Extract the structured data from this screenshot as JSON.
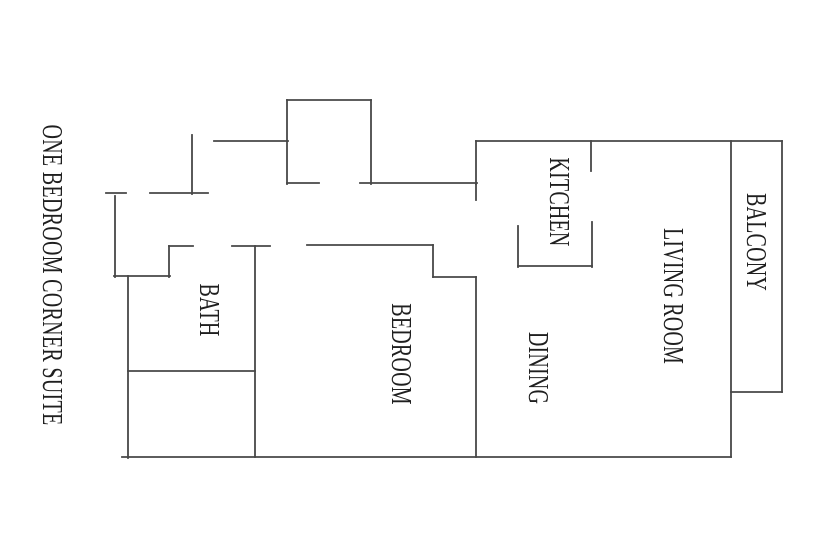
{
  "document": {
    "background_color": "#ffffff",
    "wall_color": "#474747",
    "text_color": "#1f1f1f",
    "wall_thickness": 1.8
  },
  "floorplan": {
    "title": {
      "text": "ONE BEDROOM CORNER SUITE",
      "x": 51,
      "y": 275
    },
    "rooms": [
      {
        "id": "bath",
        "text": "BATH",
        "x": 208,
        "y": 310
      },
      {
        "id": "bedroom",
        "text": "BEDROOM",
        "x": 400,
        "y": 354
      },
      {
        "id": "dining",
        "text": "DINING",
        "x": 537,
        "y": 368
      },
      {
        "id": "kitchen",
        "text": "KITCHEN",
        "x": 558,
        "y": 202
      },
      {
        "id": "living-room",
        "text": "LIVING ROOM",
        "x": 672,
        "y": 296
      },
      {
        "id": "balcony",
        "text": "BALCONY",
        "x": 755,
        "y": 242
      }
    ],
    "walls": [
      {
        "name": "entry-door-left-jamb",
        "x1": 106,
        "y1": 193,
        "x2": 126,
        "y2": 193
      },
      {
        "name": "left-outer-wall-upper",
        "x1": 115,
        "y1": 196,
        "x2": 115,
        "y2": 277
      },
      {
        "name": "entry-step-bottom-wall",
        "x1": 114,
        "y1": 276,
        "x2": 170,
        "y2": 276
      },
      {
        "name": "entry-step-right-wall",
        "x1": 169,
        "y1": 246,
        "x2": 169,
        "y2": 277
      },
      {
        "name": "bath-top-wall-left",
        "x1": 169,
        "y1": 246,
        "x2": 193,
        "y2": 246
      },
      {
        "name": "entry-top-wall",
        "x1": 150,
        "y1": 193,
        "x2": 208,
        "y2": 193
      },
      {
        "name": "entry-right-jamb",
        "x1": 192,
        "y1": 135,
        "x2": 192,
        "y2": 194
      },
      {
        "name": "top-outer-wall-left",
        "x1": 214,
        "y1": 141,
        "x2": 288,
        "y2": 141
      },
      {
        "name": "closet-top-wall",
        "x1": 287,
        "y1": 100,
        "x2": 371,
        "y2": 100
      },
      {
        "name": "closet-left-wall",
        "x1": 287,
        "y1": 100,
        "x2": 287,
        "y2": 184
      },
      {
        "name": "closet-right-wall",
        "x1": 371,
        "y1": 100,
        "x2": 371,
        "y2": 184
      },
      {
        "name": "closet-bottom-wall-left",
        "x1": 287,
        "y1": 183,
        "x2": 319,
        "y2": 183
      },
      {
        "name": "hall-top-wall",
        "x1": 360,
        "y1": 183,
        "x2": 477,
        "y2": 183
      },
      {
        "name": "kitchen-left-jamb",
        "x1": 476,
        "y1": 183,
        "x2": 476,
        "y2": 200
      },
      {
        "name": "kitchen-left-step",
        "x1": 476,
        "y1": 141,
        "x2": 476,
        "y2": 184
      },
      {
        "name": "top-outer-wall-right",
        "x1": 476,
        "y1": 141,
        "x2": 782,
        "y2": 141
      },
      {
        "name": "kitchen-right-wall-upper",
        "x1": 591,
        "y1": 141,
        "x2": 591,
        "y2": 171
      },
      {
        "name": "kitchen-right-wall-lower",
        "x1": 592,
        "y1": 222,
        "x2": 592,
        "y2": 267
      },
      {
        "name": "kitchen-bottom-wall",
        "x1": 518,
        "y1": 266,
        "x2": 592,
        "y2": 266
      },
      {
        "name": "kitchen-left-wall-lower",
        "x1": 518,
        "y1": 226,
        "x2": 518,
        "y2": 267
      },
      {
        "name": "living-balcony-divider",
        "x1": 731,
        "y1": 141,
        "x2": 731,
        "y2": 457
      },
      {
        "name": "right-outer-wall",
        "x1": 782,
        "y1": 141,
        "x2": 782,
        "y2": 392
      },
      {
        "name": "balcony-bottom-wall",
        "x1": 731,
        "y1": 392,
        "x2": 782,
        "y2": 392
      },
      {
        "name": "bath-top-wall-right",
        "x1": 232,
        "y1": 246,
        "x2": 270,
        "y2": 246
      },
      {
        "name": "bath-bedroom-divider",
        "x1": 255,
        "y1": 246,
        "x2": 255,
        "y2": 457
      },
      {
        "name": "bath-left-wall",
        "x1": 128,
        "y1": 276,
        "x2": 128,
        "y2": 458
      },
      {
        "name": "bath-closet-divider",
        "x1": 128,
        "y1": 371,
        "x2": 255,
        "y2": 371
      },
      {
        "name": "bottom-outer-wall",
        "x1": 122,
        "y1": 457,
        "x2": 731,
        "y2": 457
      },
      {
        "name": "bedroom-top-wall",
        "x1": 307,
        "y1": 245,
        "x2": 433,
        "y2": 245
      },
      {
        "name": "bedroom-top-jog-down",
        "x1": 433,
        "y1": 245,
        "x2": 433,
        "y2": 277
      },
      {
        "name": "bedroom-top-jog-right",
        "x1": 433,
        "y1": 277,
        "x2": 476,
        "y2": 277
      },
      {
        "name": "bedroom-dining-divider",
        "x1": 476,
        "y1": 277,
        "x2": 476,
        "y2": 457
      }
    ]
  }
}
